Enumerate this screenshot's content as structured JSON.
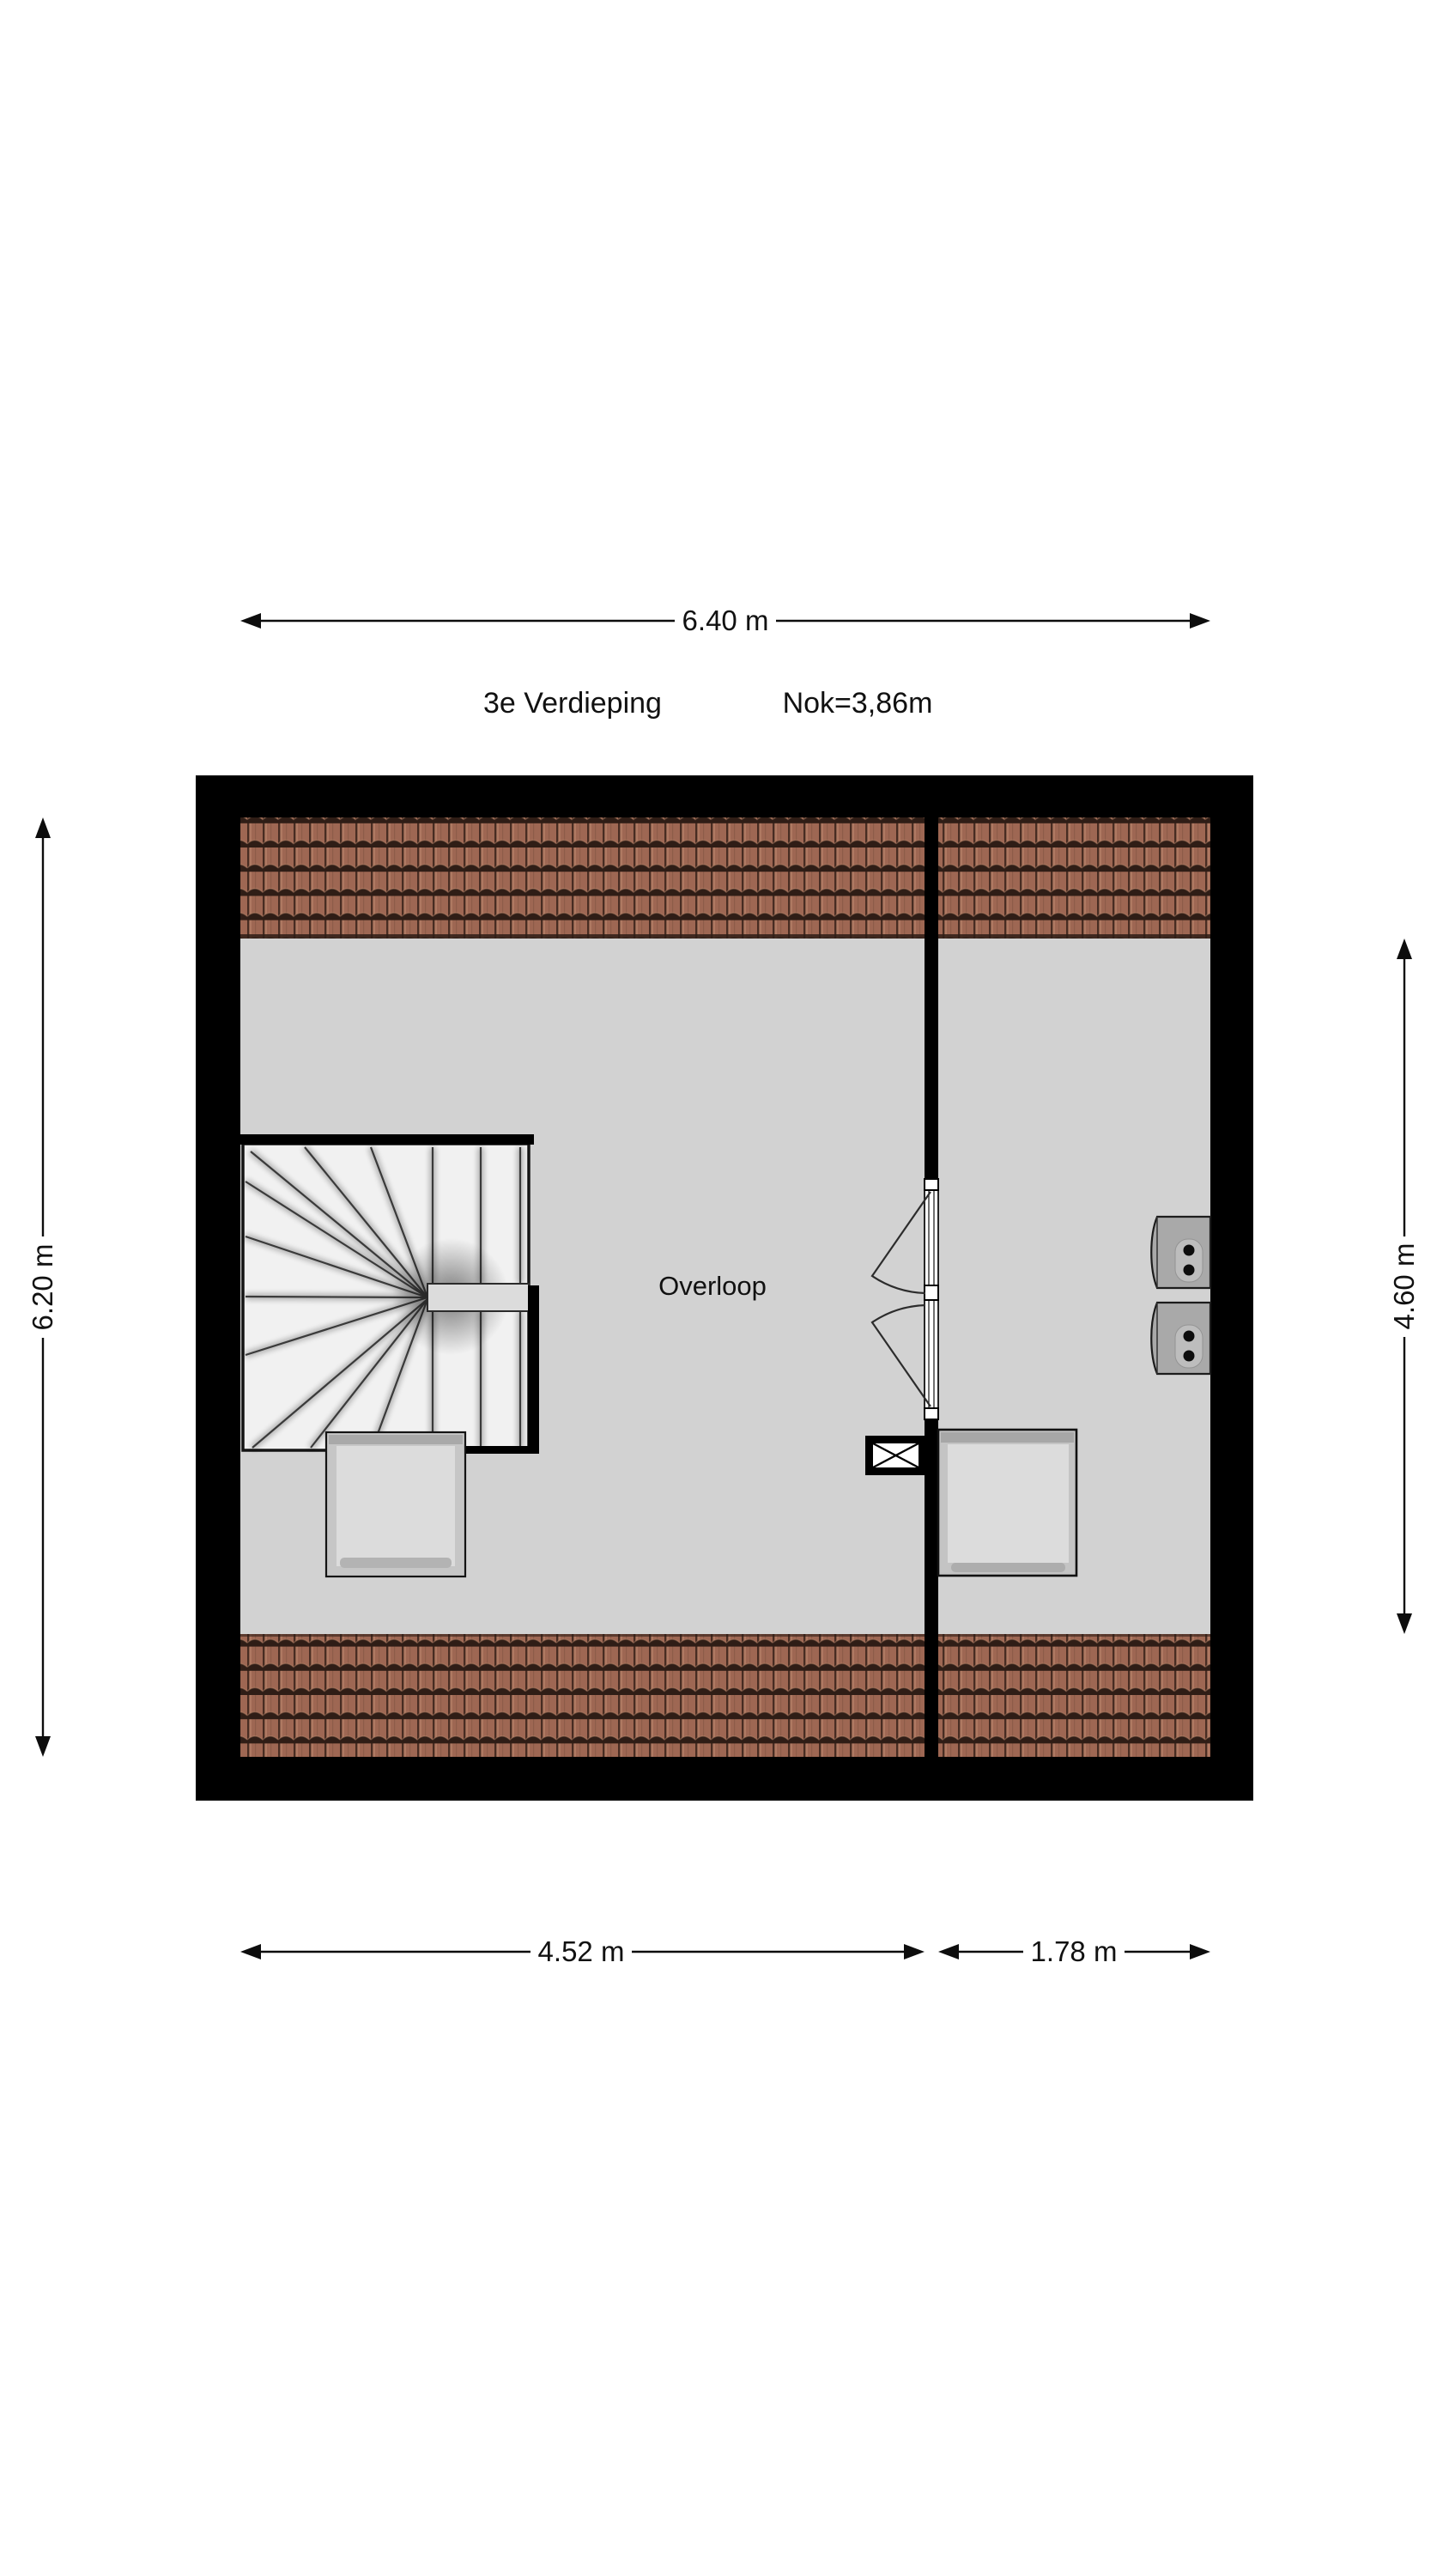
{
  "header": {
    "floor_label": "3e Verdieping",
    "ridge_label": "Nok=3,86m"
  },
  "room": {
    "label": "Overloop"
  },
  "dimensions": {
    "top": {
      "label": "6.40 m"
    },
    "left": {
      "label": "6.20 m"
    },
    "right": {
      "label": "4.60 m"
    },
    "bottom_left": {
      "label": "4.52 m"
    },
    "bottom_right": {
      "label": "1.78 m"
    }
  },
  "colors": {
    "wall": "#000000",
    "floor": "#d2d2d2",
    "tile_base": "#9e6753",
    "tile_dark": "#2f1d16",
    "tile_joint": "#472c22",
    "tile_highlight": "#b9826a",
    "stair_fill": "#f1f1f1",
    "object_fill": "#dcdcdc",
    "unit_fill": "#a9a9a9",
    "line": "#111111"
  }
}
